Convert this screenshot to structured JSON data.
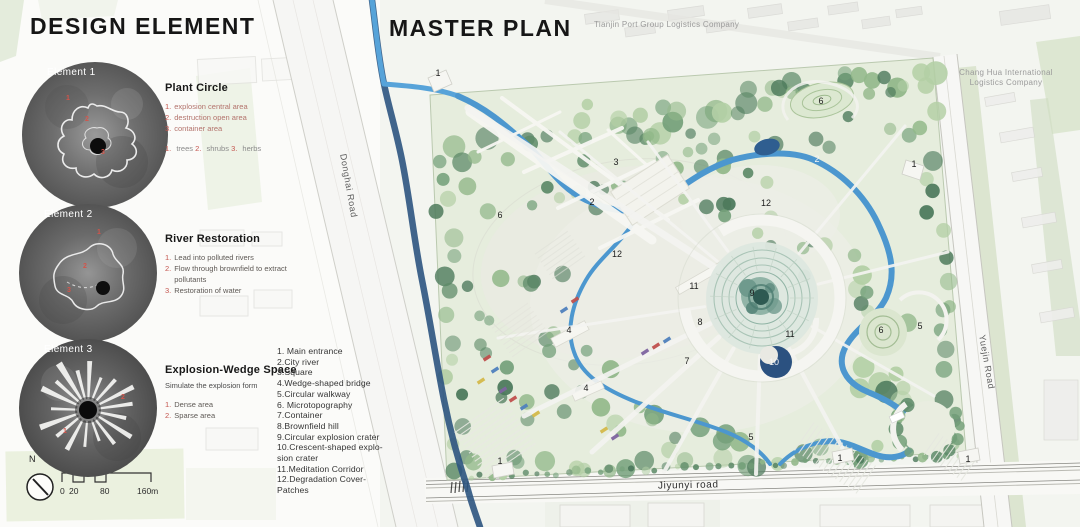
{
  "titles": {
    "left": "DESIGN ELEMENT",
    "right": "MASTER PLAN"
  },
  "elements": [
    {
      "badge": "Element 1",
      "title": "Plant Circle",
      "items": [
        {
          "num": "1.",
          "text": "explosion central area"
        },
        {
          "num": "2.",
          "text": "destruction open area"
        },
        {
          "num": "3.",
          "text": "container area"
        }
      ],
      "note_parts": [
        {
          "num": "1.",
          "text": "trees"
        },
        {
          "num": "2.",
          "text": "shrubs"
        },
        {
          "num": "3.",
          "text": "herbs"
        }
      ],
      "marks": [
        "1",
        "2",
        "3"
      ]
    },
    {
      "badge": "Element 2",
      "title": "River Restoration",
      "items": [
        {
          "num": "1.",
          "text": "Lead into polluted rivers"
        },
        {
          "num": "2.",
          "text": "Flow through brownfield to extract pollutants"
        },
        {
          "num": "3.",
          "text": "Restoration of water"
        }
      ],
      "marks": [
        "1",
        "2",
        "3"
      ]
    },
    {
      "badge": "Element 3",
      "title": "Explosion-Wedge Space",
      "subtitle": "Simulate the explosion form",
      "items": [
        {
          "num": "1.",
          "text": "Dense area"
        },
        {
          "num": "2.",
          "text": "Sparse area"
        }
      ],
      "marks": [
        "1",
        "2"
      ]
    }
  ],
  "legend": {
    "lines": [
      "1. Main entrance",
      "2.City river",
      "3.Square",
      "4.Wedge-shaped bridge",
      "5.Circular walkway",
      "6. Microtopography",
      "7.Container",
      "8.Brownfield hill",
      "9.Circular explosion crater",
      "10.Crescent-shaped explo-",
      "sion crater",
      "11.Meditation Corridor",
      "12.Degradation Cover-",
      "Patches"
    ]
  },
  "plan": {
    "company_top": "Tianjin Port Group Logistics Company",
    "company_right": "Chang Hua International Logistics Company",
    "road_left": "Donghai Road",
    "road_right": "Yuejin Road",
    "road_bottom": "Jiyunyi road",
    "markers": [
      {
        "n": "1",
        "x": 438,
        "y": 73
      },
      {
        "n": "3",
        "x": 616,
        "y": 162
      },
      {
        "n": "2",
        "x": 592,
        "y": 202
      },
      {
        "n": "6",
        "x": 500,
        "y": 215
      },
      {
        "n": "6",
        "x": 821,
        "y": 101
      },
      {
        "n": "2",
        "x": 817,
        "y": 159,
        "light": true
      },
      {
        "n": "1",
        "x": 914,
        "y": 164
      },
      {
        "n": "12",
        "x": 766,
        "y": 203
      },
      {
        "n": "12",
        "x": 617,
        "y": 254
      },
      {
        "n": "11",
        "x": 694,
        "y": 286
      },
      {
        "n": "9",
        "x": 752,
        "y": 293
      },
      {
        "n": "8",
        "x": 700,
        "y": 322
      },
      {
        "n": "11",
        "x": 790,
        "y": 334
      },
      {
        "n": "10",
        "x": 774,
        "y": 362,
        "light": true
      },
      {
        "n": "7",
        "x": 687,
        "y": 361
      },
      {
        "n": "4",
        "x": 569,
        "y": 330
      },
      {
        "n": "4",
        "x": 586,
        "y": 388
      },
      {
        "n": "1",
        "x": 500,
        "y": 461
      },
      {
        "n": "6",
        "x": 881,
        "y": 330
      },
      {
        "n": "5",
        "x": 920,
        "y": 326
      },
      {
        "n": "5",
        "x": 751,
        "y": 437
      },
      {
        "n": "1",
        "x": 840,
        "y": 458
      },
      {
        "n": "1",
        "x": 968,
        "y": 459
      }
    ]
  },
  "scalebar": {
    "north": "N",
    "ticks": [
      {
        "label": "0",
        "x": 60
      },
      {
        "label": "20",
        "x": 69
      },
      {
        "label": "80",
        "x": 100
      },
      {
        "label": "160m",
        "x": 137
      }
    ]
  },
  "colors": {
    "accent_red": "#c4554e",
    "river_blue": "#4c97cf",
    "canal_blue": "#2c5480",
    "park_green": "#7aa37f",
    "crater_teal": "#84aa9c",
    "container_palette": [
      "#c0504d",
      "#4f81bd",
      "#d4b94a",
      "#7e64a0"
    ]
  }
}
